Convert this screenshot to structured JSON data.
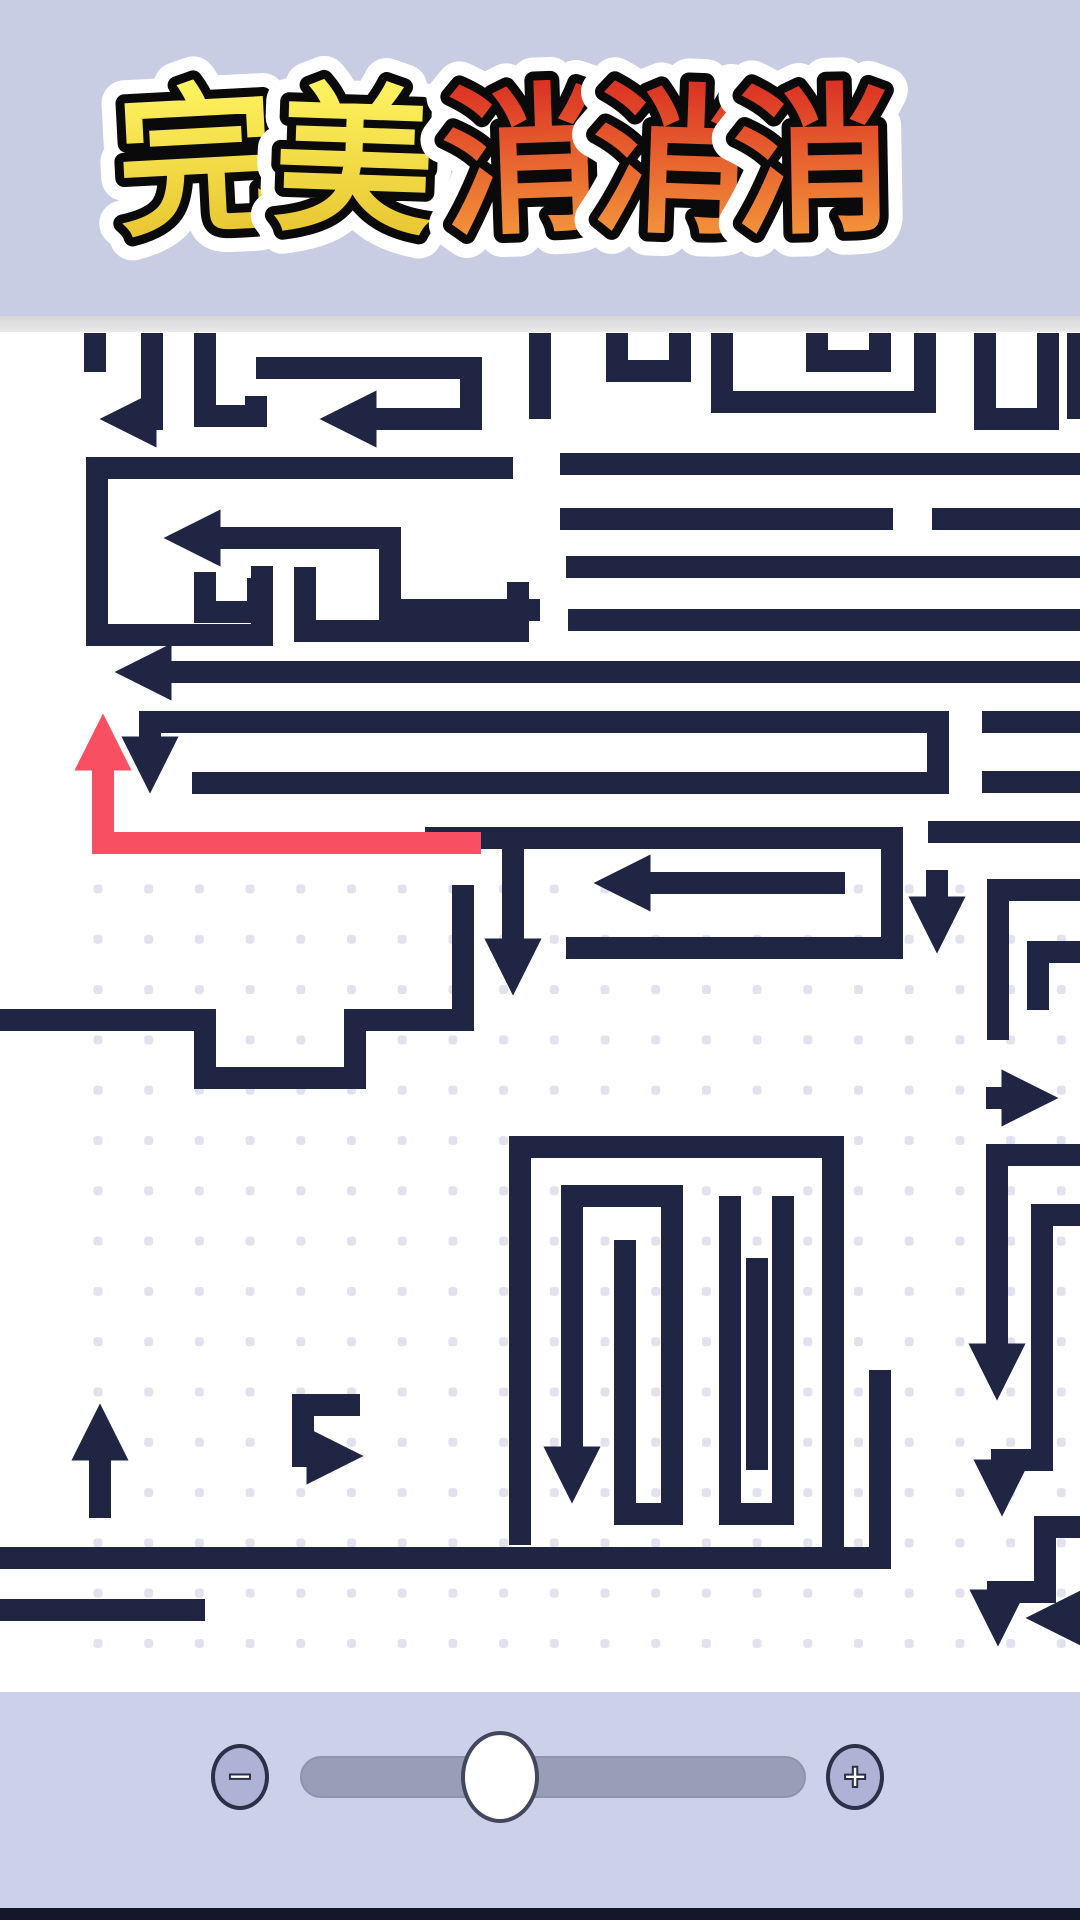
{
  "title": {
    "text": "完美消消消",
    "chars": [
      {
        "ch": "完",
        "palette": "yellow"
      },
      {
        "ch": "美",
        "palette": "yellow"
      },
      {
        "ch": "消",
        "palette": "red"
      },
      {
        "ch": "消",
        "palette": "red"
      },
      {
        "ch": "消",
        "palette": "red"
      }
    ]
  },
  "colors": {
    "banner_bg": "#c9cde3",
    "board_bg": "#ffffff",
    "navy": "#212544",
    "red": "#f94f62",
    "dot": "#e2e2ee",
    "bottombar_bg": "#ccd0e8",
    "foot_strip": "#14172a",
    "title_yellow_top": "#fff763",
    "title_yellow_bottom": "#e5c02b",
    "title_red_top": "#d92a22",
    "title_red_bottom": "#f6a03d"
  },
  "board": {
    "stroke_width": 22,
    "dots": {
      "origin_x": 98,
      "origin_y": 889,
      "spacing_x": 50.7,
      "spacing_y": 50.3,
      "size": 9,
      "region": {
        "x": 85,
        "y": 882,
        "w": 995,
        "h": 770
      }
    },
    "paths": [
      {
        "d": "M95 333 V372"
      },
      {
        "d": "M152 333 V419 H148",
        "arrow": true
      },
      {
        "d": "M205 333 V416 H256 V396"
      },
      {
        "d": "M256 368 H471 V419 H368",
        "arrow": true
      },
      {
        "d": "M540 333 V419"
      },
      {
        "d": "M617 333 V371 H680 V333"
      },
      {
        "d": "M722 333 V402 H925 V333"
      },
      {
        "d": "M817 333 V361 H880 V333"
      },
      {
        "d": "M985 333 V419 H1048 V333"
      },
      {
        "d": "M1078 333 V419"
      },
      {
        "d": "M513 468 H97 V635 H262 V566"
      },
      {
        "d": "M540 610 H390 V538 H212",
        "arrow": true
      },
      {
        "d": "M205 572 V612 H258 V578"
      },
      {
        "d": "M305 567 V631 H518 V582"
      },
      {
        "d": "M566 567 H1080"
      },
      {
        "d": "M560 464 H1080"
      },
      {
        "d": "M560 519 H893"
      },
      {
        "d": "M932 519 H1080"
      },
      {
        "d": "M568 620 H1080"
      },
      {
        "d": "M1080 672 H163",
        "arrow": true
      },
      {
        "d": "M192 783 H938 V722 H150 V745",
        "arrow": true
      },
      {
        "d": "M982 722 H1080"
      },
      {
        "d": "M982 782 H1080"
      },
      {
        "d": "M425 838 H892 V948 H566"
      },
      {
        "d": "M845 883 H642",
        "arrow": true
      },
      {
        "d": "M937 870 V905",
        "arrow": true
      },
      {
        "d": "M928 832 H1080"
      },
      {
        "d": "M1080 890 H998 V1040"
      },
      {
        "d": "M1080 952 H1038 V1010"
      },
      {
        "d": "M986 1098 H1010",
        "arrow": true
      },
      {
        "d": "M0 1020 H205 V1078 H355 V1020 H463 V885"
      },
      {
        "d": "M513 828 V947",
        "arrow": true
      },
      {
        "d": "M1080 1155 H997 V1352",
        "arrow": true
      },
      {
        "d": "M1080 1215 H1042 V1460 H1002 V1468",
        "arrow": true
      },
      {
        "d": "M1080 1527 H1045 V1592 H998 V1598",
        "arrow": true
      },
      {
        "d": "M1080 1618 H1074",
        "arrow": true
      },
      {
        "d": "M520 1545 V1147 H833 V1548"
      },
      {
        "d": "M625 1240 V1514 H672 V1196 H572 V1455",
        "arrow": true
      },
      {
        "d": "M730 1196 V1514 H783 V1196"
      },
      {
        "d": "M757 1258 V1470"
      },
      {
        "d": "M0 1558 H880 V1370"
      },
      {
        "d": "M0 1610 H205"
      },
      {
        "d": "M100 1518 V1452",
        "arrow": true
      },
      {
        "d": "M360 1405 H303 V1456 H315",
        "arrow": true
      },
      {
        "d": "M481 843 H103 V762",
        "arrow": true,
        "red": true
      }
    ]
  },
  "slider": {
    "minus_label": "−",
    "plus_label": "+",
    "knob_percent": 39.5
  }
}
